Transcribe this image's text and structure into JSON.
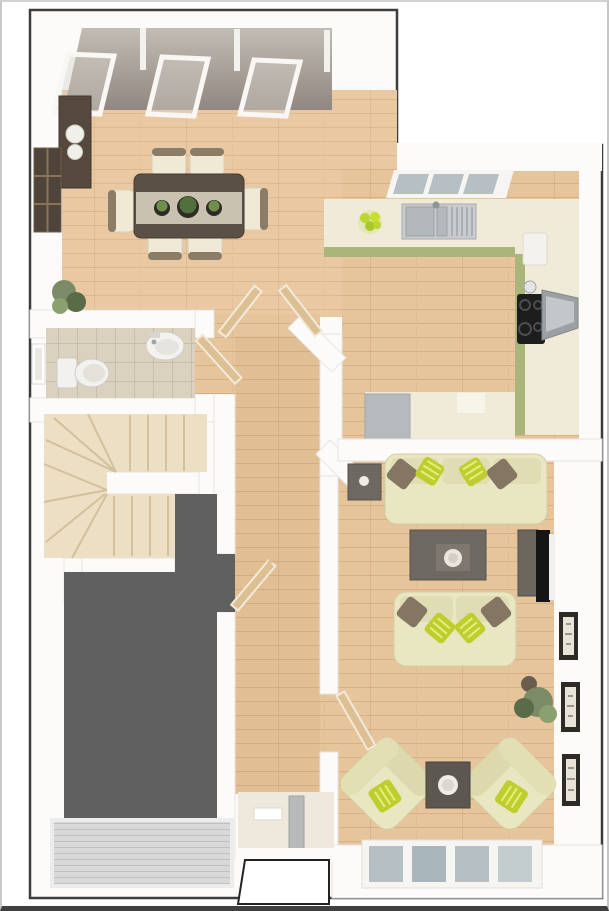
{
  "image": {
    "kind": "3d-floorplan-render",
    "view": "top-down dollhouse cutaway",
    "visible_text": "none"
  },
  "colors": {
    "page_bg": "#ffffff",
    "frame_light": "#c9c9c9",
    "frame_dark": "#3f3f3f",
    "outline": "#3c3c3c",
    "wall": "#fcfbfa",
    "wall_shade": "#e9e6e2",
    "wood": "#e6c49c",
    "wood_line": "#b98a55",
    "garage_floor": "#606060",
    "garage_door": "#d8d8d8",
    "garage_door_line": "#c0c0c0",
    "carpet": "#ecdfc4",
    "carpet_line": "#d3c09c",
    "tile": "#dbd1bf",
    "tile_line": "#c8bcaa",
    "counter_cream": "#f0ead9",
    "cabinet_green": "#a9b57a",
    "appliance_gray": "#b7babc",
    "steel": "#c9ccce",
    "hob_black": "#1d1d1d",
    "roof_gray": "#a29a93",
    "sofa_cream": "#e9e7c1",
    "sofa_edge": "#d2cfa2",
    "cushion_lime": "#c0cd2e",
    "cushion_brown": "#857663",
    "table_gray": "#6e6862",
    "wood_dark_furniture": "#55493d",
    "runner_beige": "#c9c2b0",
    "chair_cream": "#f0e9d6",
    "tv_black": "#151515",
    "picture_frame": "#2e2a26",
    "plant_green": "#7c8b67",
    "plant_dark": "#5a6b48",
    "door_wood": "#dcc093",
    "porch_floor": "#efe9dd",
    "window_pane": "#b6c0c4"
  },
  "rooms": [
    {
      "id": "dining-area",
      "items": [
        "dining-table",
        "table-runner",
        "potted-centrepieces x3",
        "dining-chair x6",
        "sideboard",
        "decor-bowls x2",
        "grid-wall-art",
        "skylight x3",
        "floor-plant"
      ]
    },
    {
      "id": "kitchen",
      "items": [
        "u-shaped-worktop",
        "green-cabinet-fronts",
        "triple-window",
        "sink-with-drainer",
        "fruit-bowl",
        "hob",
        "extractor-hood",
        "kettle",
        "counter-appliance",
        "washing-machine"
      ]
    },
    {
      "id": "wc",
      "items": [
        "toilet",
        "corner-basin",
        "tiled-floor",
        "wall-window",
        "door"
      ]
    },
    {
      "id": "staircase",
      "items": [
        "winder-stairs",
        "carpet",
        "spine-wall"
      ]
    },
    {
      "id": "garage",
      "items": [
        "dark-floor",
        "ribbed-garage-door"
      ]
    },
    {
      "id": "hallway",
      "items": [
        "french-doors x2",
        "garage-access-door",
        "living-room-door",
        "front-door",
        "doormat"
      ]
    },
    {
      "id": "living-area",
      "items": [
        "three-seat-sofa",
        "two-seat-sofa",
        "armchair x2",
        "coffee-table",
        "side-table x2",
        "tv-unit",
        "tv",
        "wall-picture x3",
        "floor-plant",
        "four-pane-window"
      ]
    },
    {
      "id": "entrance-porch",
      "items": [
        "porch-slab"
      ]
    }
  ]
}
